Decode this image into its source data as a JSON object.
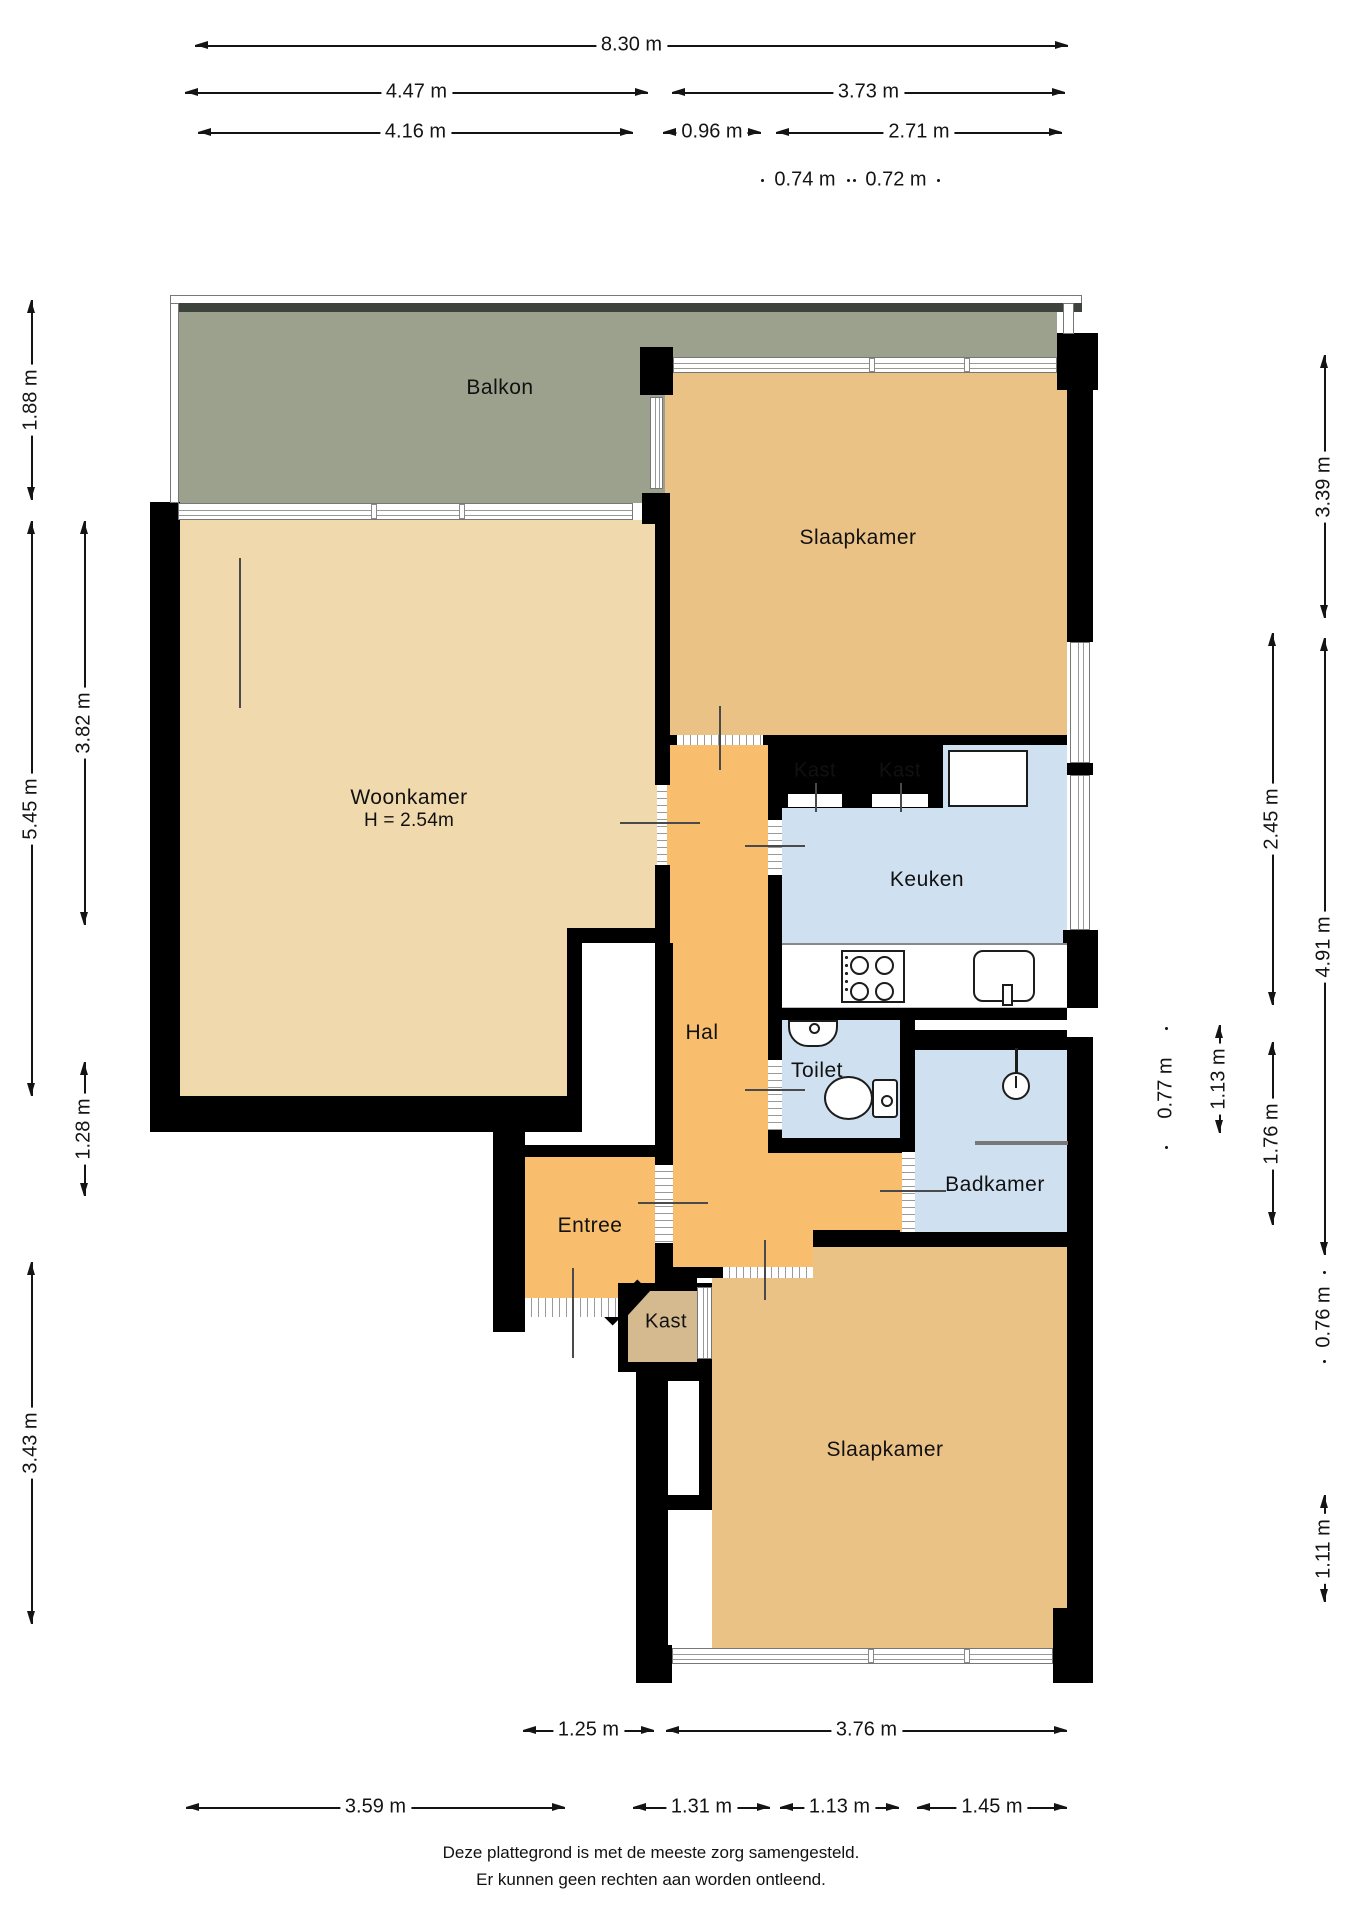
{
  "colors": {
    "wall": "#000000",
    "balcony": "#9ba18c",
    "living": "#f0d9ac",
    "bedroom": "#ebc286",
    "closet_top": "#deb87e",
    "closet_bottom": "#d6ba8f",
    "hall": "#f8bd6d",
    "wet_room": "#cfe0f0",
    "white": "#ffffff"
  },
  "rooms": [
    {
      "id": "balkon",
      "label": "Balkon"
    },
    {
      "id": "slaapkamer-top",
      "label": "Slaapkamer"
    },
    {
      "id": "woonkamer",
      "label": "Woonkamer",
      "sub": "H = 2.54m"
    },
    {
      "id": "kast-1",
      "label": "Kast"
    },
    {
      "id": "kast-2",
      "label": "Kast"
    },
    {
      "id": "keuken",
      "label": "Keuken"
    },
    {
      "id": "hal",
      "label": "Hal"
    },
    {
      "id": "toilet",
      "label": "Toilet"
    },
    {
      "id": "badkamer",
      "label": "Badkamer"
    },
    {
      "id": "entree",
      "label": "Entree"
    },
    {
      "id": "kast-3",
      "label": "Kast"
    },
    {
      "id": "slaapkamer-bottom",
      "label": "Slaapkamer"
    }
  ],
  "dims": {
    "t1": "8.30 m",
    "t2": "4.47 m",
    "t3": "3.73 m",
    "t4": "4.16 m",
    "t5": "0.96 m",
    "t6": "2.71 m",
    "t7": "0.74 m",
    "t8": "0.72 m",
    "l1": "1.88 m",
    "l2": "5.45 m",
    "l3": "3.82 m",
    "l4": "1.28 m",
    "l5": "3.43 m",
    "r1": "3.39 m",
    "r2": "2.45 m",
    "r3": "4.91 m",
    "r4": "0.77 m",
    "r5": "1.13 m",
    "r6": "1.76 m",
    "r7": "0.76 m",
    "r8": "1.11 m",
    "b1": "1.25 m",
    "b2": "3.76 m",
    "b3": "3.59 m",
    "b4": "1.31 m",
    "b5": "1.13 m",
    "b6": "1.45 m"
  },
  "footer": {
    "line1": "Deze plattegrond is met de meeste zorg samengesteld.",
    "line2": "Er kunnen geen rechten aan worden ontleend."
  }
}
